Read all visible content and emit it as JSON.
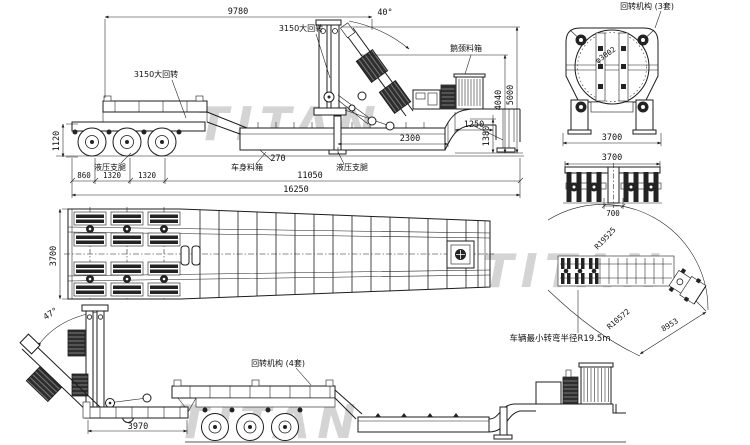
{
  "watermark": {
    "text": "TITAN",
    "color": "#d4d4d4"
  },
  "colors": {
    "line": "#1c1c1c",
    "background": "#ffffff"
  },
  "side_view_raised": {
    "labels": {
      "dim_9780": "9780",
      "angle_40": "40°",
      "slew_upper": "3150大回转",
      "slew_lower": "3150大回转",
      "gooseneck_box": "鹅颈料箱",
      "dim_5000": "5000",
      "dim_4040": "4040",
      "dim_1250": "1250",
      "dim_1380": "1380",
      "dim_2300": "2300",
      "dim_270": "270",
      "body_box": "车身料箱",
      "leg_rear": "液压支腿",
      "leg_front": "液压支腿",
      "dim_1120": "1120",
      "dim_860": "860",
      "dim_1320_a": "1320",
      "dim_1320_b": "1320",
      "dim_11050": "11050",
      "dim_16250": "16250"
    }
  },
  "front_view": {
    "labels": {
      "mechanism": "回转机构 (3套)",
      "diameter": "φ3002",
      "dim_3700": "3700"
    }
  },
  "axle_view": {
    "labels": {
      "dim_3700": "3700",
      "dim_700": "700"
    }
  },
  "plan_view": {
    "labels": {
      "dim_3700": "3700"
    }
  },
  "tilted_view": {
    "labels": {
      "angle_47": "47°",
      "mechanism": "回转机构 (4套)",
      "dim_3970": "3970"
    }
  },
  "turning_view": {
    "labels": {
      "r_outer": "R19525",
      "r_inner": "R10572",
      "dim_8953": "8953",
      "note": "车辆最小转弯半径R19.5m"
    }
  }
}
